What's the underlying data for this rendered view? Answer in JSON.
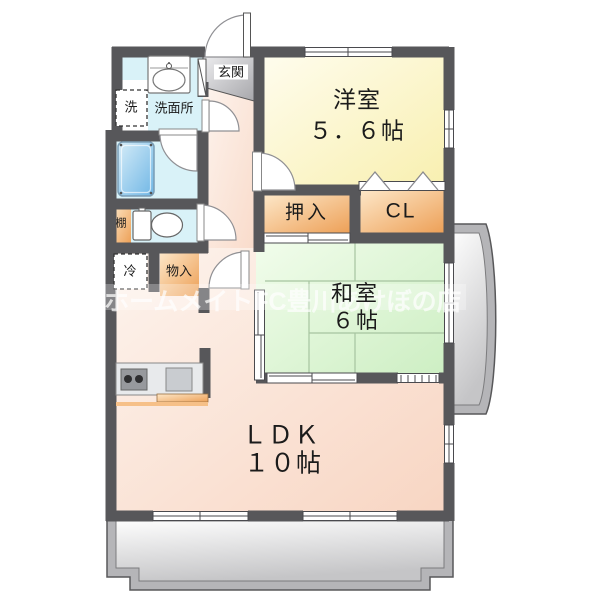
{
  "watermark": "ホームメイトFC豊川あけぼの店",
  "rooms": {
    "entrance": {
      "label": "玄関"
    },
    "washroom": {
      "label": "洗面所"
    },
    "washer": {
      "label": "洗"
    },
    "shelf": {
      "label": "棚"
    },
    "fridge": {
      "label": "冷"
    },
    "storage": {
      "label": "物入"
    },
    "oshiire": {
      "label": "押入"
    },
    "closet": {
      "label": "CL"
    },
    "western_room": {
      "name": "洋室",
      "size": "５．６帖"
    },
    "japanese_room": {
      "name": "和室",
      "size": "６帖"
    },
    "ldk": {
      "name": "ＬＤＫ",
      "size": "１０帖"
    }
  },
  "colors": {
    "wall": "#57575a",
    "western_room_fill": "#f8efae",
    "japanese_room_fill": "#cceec2",
    "ldk_fill": "#f8d5c2",
    "storage_fill": "#eda057",
    "wet_area_fill": "#d9f2f8",
    "bathtub_fill": "#6fb6e5",
    "entrance_fill": "#a7a7ab",
    "balcony_fill": "#b5b5b8"
  }
}
